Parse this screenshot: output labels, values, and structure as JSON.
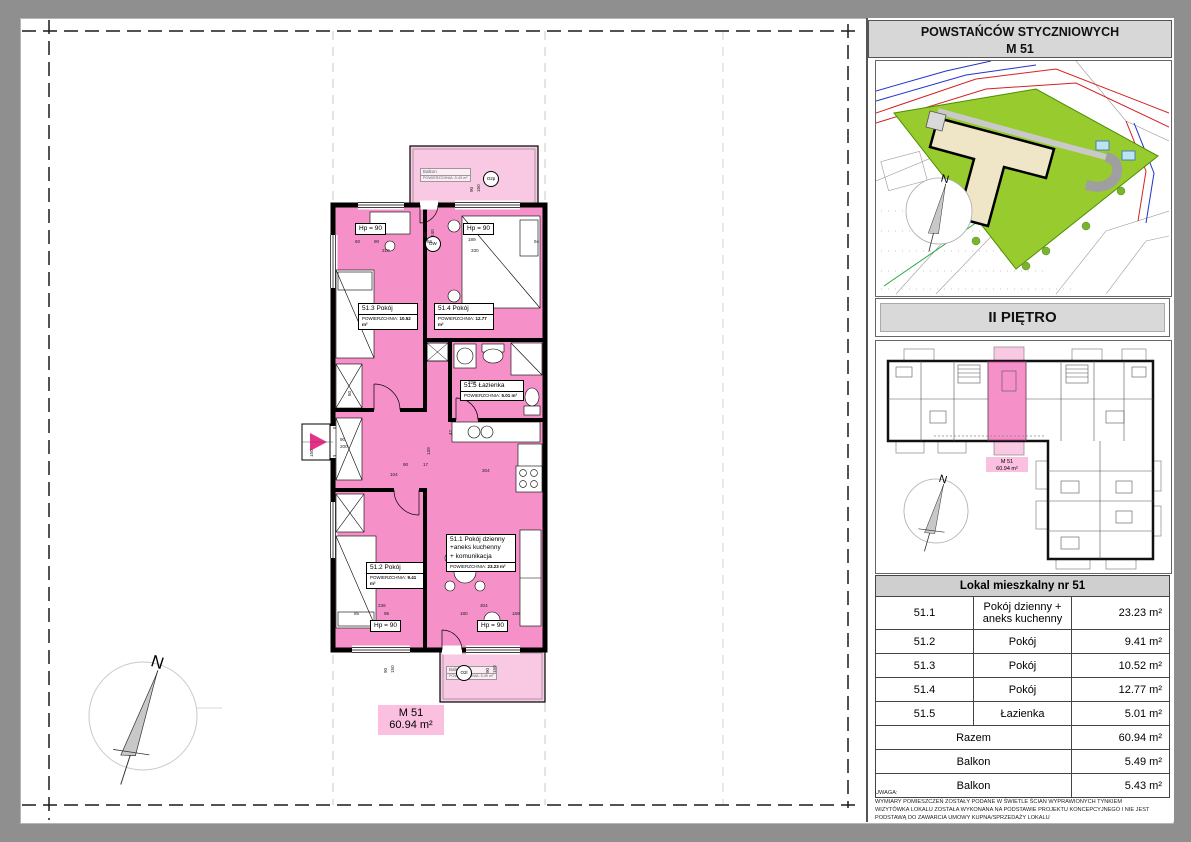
{
  "header": {
    "street": "POWSTAŃCÓW STYCZNIOWYCH",
    "unit": "M 51",
    "floor": "II PIĘTRO"
  },
  "plan": {
    "badge": {
      "name": "M 51",
      "area": "60.94 m²"
    },
    "compass_n": "N",
    "rooms": [
      {
        "id": "51.3",
        "x": 336,
        "y": 283,
        "w": 58,
        "title_lines": [
          "51.3  Pokój"
        ],
        "area_label": "POWIERZCHNIA:",
        "area": "10.52 m²"
      },
      {
        "id": "51.4",
        "x": 412,
        "y": 283,
        "w": 58,
        "title_lines": [
          "51.4  Pokój"
        ],
        "area_label": "POWIERZCHNIA:",
        "area": "12.77 m²"
      },
      {
        "id": "51.5",
        "x": 438,
        "y": 360,
        "w": 62,
        "title_lines": [
          "51.5  Łazienka"
        ],
        "area_label": "POWIERZCHNIA:",
        "area": "5.01 m²"
      },
      {
        "id": "51.1",
        "x": 424,
        "y": 514,
        "w": 68,
        "title_lines": [
          "51.1  Pokój dzienny",
          "+aneks kuchenny",
          "+    komunikacja"
        ],
        "area_label": "POWIERZCHNIA:",
        "area": "23.23 m²"
      },
      {
        "id": "51.2",
        "x": 344,
        "y": 542,
        "w": 56,
        "title_lines": [
          "51.2  Pokój"
        ],
        "area_label": "POWIERZCHNIA:",
        "area": "9.41 m²"
      }
    ],
    "balconies": [
      {
        "x": 398,
        "y": 148,
        "title": "Balkon",
        "area_label": "POWIERZCHNIA:",
        "area": "5.43 m²"
      },
      {
        "x": 424,
        "y": 646,
        "title": "Balkon",
        "area_label": "POWIERZCHNIA:",
        "area": "5.49 m²"
      }
    ],
    "hp_labels": [
      {
        "t": "Hp = 90",
        "x": 333,
        "y": 203
      },
      {
        "t": "Hp = 90",
        "x": 441,
        "y": 203
      },
      {
        "t": "Hp = 90",
        "x": 348,
        "y": 600
      },
      {
        "t": "Hp = 90",
        "x": 455,
        "y": 600
      }
    ],
    "markers": [
      {
        "t": "O2p",
        "x": 461,
        "y": 151
      },
      {
        "t": "DW",
        "x": 403,
        "y": 216
      },
      {
        "t": "O2l",
        "x": 434,
        "y": 645
      }
    ],
    "dimensions": [
      {
        "t": "60",
        "x": 333,
        "y": 219
      },
      {
        "t": "90",
        "x": 352,
        "y": 219
      },
      {
        "t": "210",
        "x": 360,
        "y": 228
      },
      {
        "t": "56",
        "x": 405,
        "y": 219
      },
      {
        "t": "189",
        "x": 446,
        "y": 217
      },
      {
        "t": "330",
        "x": 449,
        "y": 228
      },
      {
        "t": "94",
        "x": 512,
        "y": 219
      },
      {
        "t": "80",
        "x": 406,
        "y": 212,
        "r": 90
      },
      {
        "t": "240",
        "x": 413,
        "y": 212,
        "r": 90
      },
      {
        "t": "90",
        "x": 452,
        "y": 167,
        "r": 90
      },
      {
        "t": "150",
        "x": 459,
        "y": 167,
        "r": 90
      },
      {
        "t": "90",
        "x": 318,
        "y": 417
      },
      {
        "t": "200",
        "x": 318,
        "y": 424
      },
      {
        "t": "150",
        "x": 292,
        "y": 432,
        "r": 90
      },
      {
        "t": "90",
        "x": 381,
        "y": 442
      },
      {
        "t": "17",
        "x": 401,
        "y": 442
      },
      {
        "t": "139",
        "x": 409,
        "y": 430,
        "r": 90
      },
      {
        "t": "42",
        "x": 431,
        "y": 410,
        "r": 90
      },
      {
        "t": "304",
        "x": 460,
        "y": 448
      },
      {
        "t": "228",
        "x": 446,
        "y": 360
      },
      {
        "t": "80",
        "x": 330,
        "y": 371,
        "r": 90
      },
      {
        "t": "104",
        "x": 368,
        "y": 452
      },
      {
        "t": "85",
        "x": 332,
        "y": 591
      },
      {
        "t": "95",
        "x": 362,
        "y": 591
      },
      {
        "t": "236",
        "x": 356,
        "y": 583
      },
      {
        "t": "304",
        "x": 458,
        "y": 583
      },
      {
        "t": "180",
        "x": 438,
        "y": 591
      },
      {
        "t": "169",
        "x": 490,
        "y": 591
      },
      {
        "t": "90",
        "x": 366,
        "y": 648,
        "r": 90
      },
      {
        "t": "150",
        "x": 373,
        "y": 648,
        "r": 90
      },
      {
        "t": "90",
        "x": 468,
        "y": 648,
        "r": 90
      },
      {
        "t": "150",
        "x": 475,
        "y": 648,
        "r": 90
      }
    ]
  },
  "sidebar": {
    "overview_unit_label": {
      "l1": "M 51",
      "l2": "60.94 m²"
    },
    "table": {
      "header": "Lokal mieszkalny nr 51",
      "rows": [
        {
          "id": "51.1",
          "name": "Pokój dzienny + aneks kuchenny",
          "area": "23.23 m²"
        },
        {
          "id": "51.2",
          "name": "Pokój",
          "area": "9.41 m²"
        },
        {
          "id": "51.3",
          "name": "Pokój",
          "area": "10.52 m²"
        },
        {
          "id": "51.4",
          "name": "Pokój",
          "area": "12.77 m²"
        },
        {
          "id": "51.5",
          "name": "Łazienka",
          "area": "5.01 m²"
        }
      ],
      "totals": [
        {
          "label": "Razem",
          "area": "60.94 m²"
        },
        {
          "label": "Balkon",
          "area": "5.49 m²"
        },
        {
          "label": "Balkon",
          "area": "5.43 m²"
        }
      ]
    },
    "note_lines": [
      "UWAGA:",
      "WYMIARY POMIESZCZEŃ ZOSTAŁY PODANE W ŚWIETLE ŚCIAN WYPRAWIONYCH TYNKIEM",
      "WIZYTÓWKA LOKALU ZOSTAŁA WYKONANA NA PODSTAWIE PROJEKTU KONCEPCYJNEGO I  NIE JEST",
      "PODSTAWĄ DO ZAWARCIA UMOWY KUPNA/SPRZEDAŻY LOKALU"
    ]
  },
  "colors": {
    "room_pink": "#f591c8",
    "balcony_pink": "#f9c8e2",
    "badge_pink": "#fbc0e0",
    "site_green": "#98cb2e",
    "building_beige": "#efe5c7"
  }
}
